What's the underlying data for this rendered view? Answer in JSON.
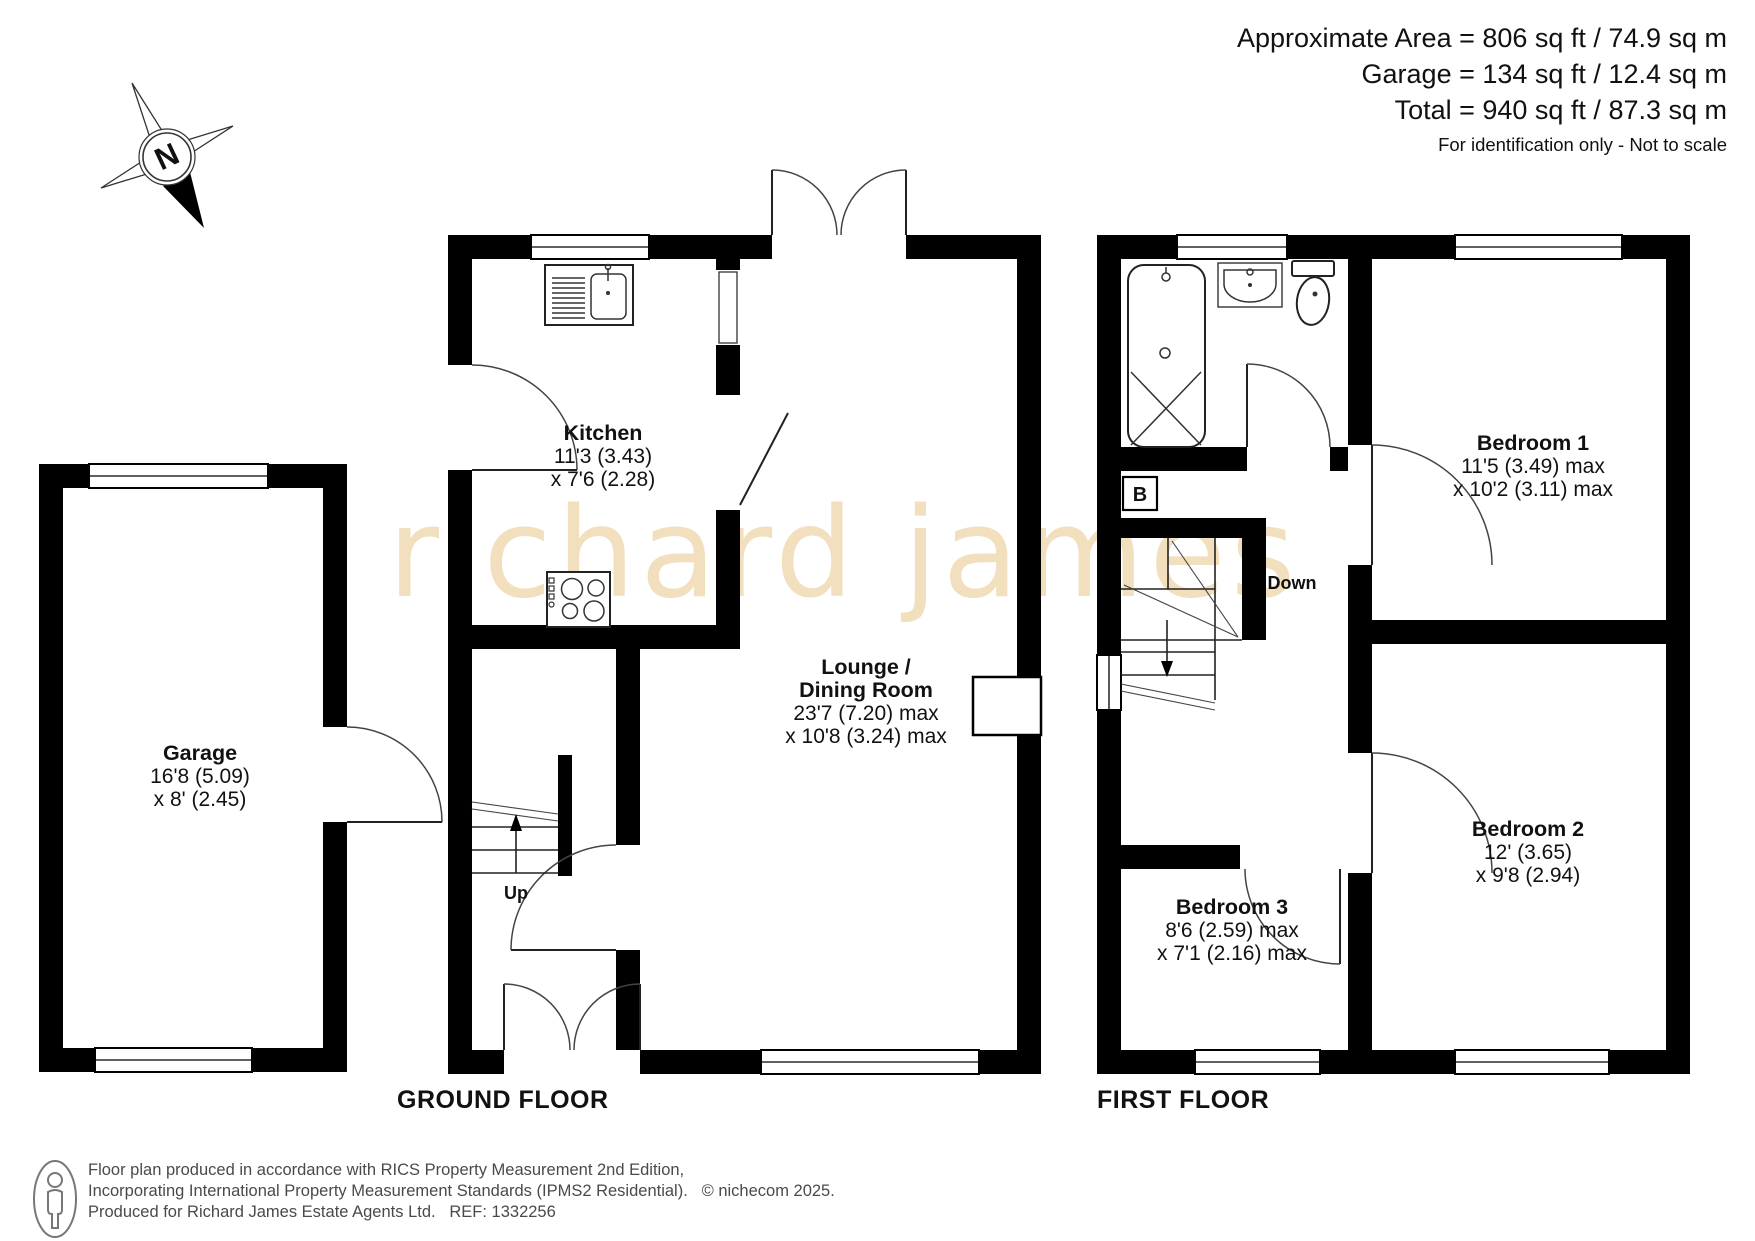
{
  "header": {
    "line1": "Approximate Area = 806 sq ft / 74.9 sq m",
    "line2": "Garage = 134 sq ft / 12.4 sq m",
    "line3": "Total = 940 sq ft / 87.3 sq m",
    "note": "For identification only - Not to scale"
  },
  "watermark": "richard james",
  "compass": {
    "label": "N"
  },
  "floors": {
    "ground": {
      "label": "GROUND FLOOR",
      "stairs_label": "Up",
      "rooms": {
        "kitchen": {
          "name": "Kitchen",
          "dim1": "11'3 (3.43)",
          "dim2": "x 7'6 (2.28)"
        },
        "lounge": {
          "name1": "Lounge /",
          "name2": "Dining Room",
          "dim1": "23'7 (7.20) max",
          "dim2": "x 10'8 (3.24) max"
        },
        "garage": {
          "name": "Garage",
          "dim1": "16'8 (5.09)",
          "dim2": "x 8' (2.45)"
        }
      }
    },
    "first": {
      "label": "FIRST FLOOR",
      "stairs_label": "Down",
      "boiler_label": "B",
      "rooms": {
        "bedroom1": {
          "name": "Bedroom 1",
          "dim1": "11'5 (3.49) max",
          "dim2": "x 10'2 (3.11) max"
        },
        "bedroom2": {
          "name": "Bedroom 2",
          "dim1": "12' (3.65)",
          "dim2": "x 9'8 (2.94)"
        },
        "bedroom3": {
          "name": "Bedroom 3",
          "dim1": "8'6 (2.59) max",
          "dim2": "x 7'1 (2.16) max"
        }
      }
    }
  },
  "footer": {
    "line1": "Floor plan produced in accordance with RICS Property Measurement 2nd Edition,",
    "line2": "Incorporating International Property Measurement Standards (IPMS2 Residential).",
    "copyright": "© nichecom 2025.",
    "line3": "Produced for Richard James Estate Agents Ltd.",
    "ref": "REF: 1332256"
  },
  "colors": {
    "wall": "#000000",
    "watermark": "#f1dfbd",
    "footer_text": "#4a4a4a"
  }
}
